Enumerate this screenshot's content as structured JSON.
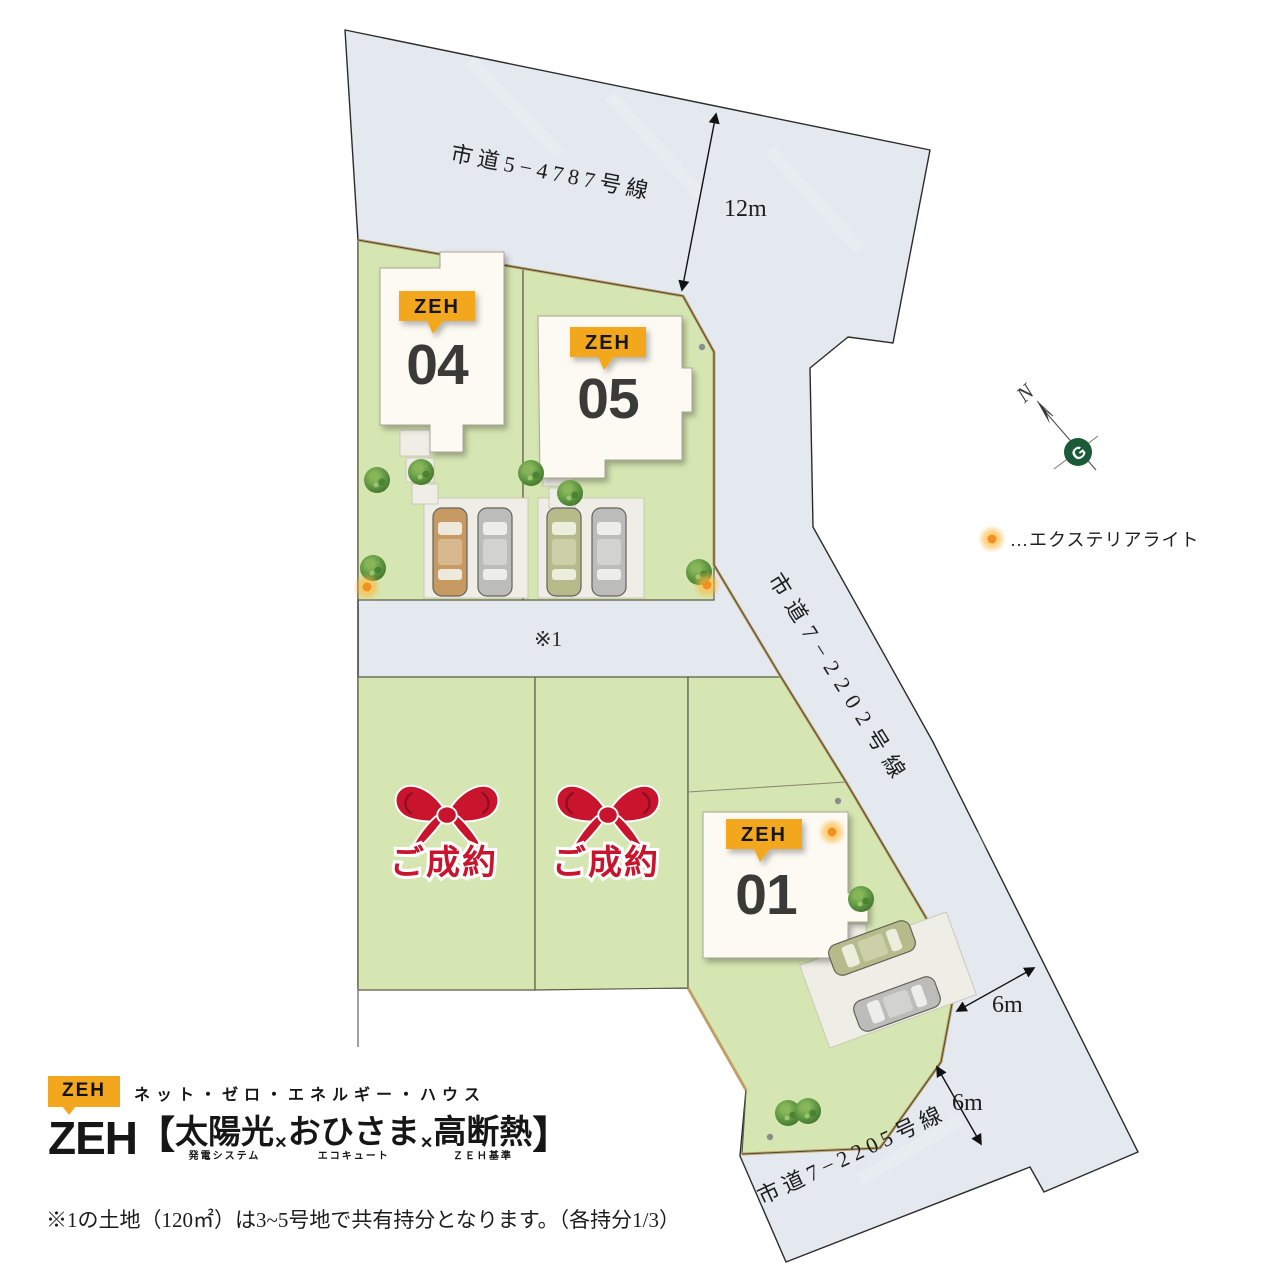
{
  "colors": {
    "accent_yellow": "#F2A71F",
    "sold_red": "#C8142C",
    "lot_green": "#D6E6B2",
    "road_gray": "#E4E9EF",
    "number_dark": "#3A3A38",
    "logo_green": "#1B5A36"
  },
  "map": {
    "roads": {
      "top": "市道5−4787号線",
      "east": "市道7−2202号線",
      "south": "市道7−2205号線"
    },
    "dimensions": {
      "top_road_width": "12m",
      "east_gap": "6m",
      "south_gap": "6m"
    },
    "shared_area_marker": "※1",
    "compass_label": "N",
    "legend": {
      "marker": "exterior-light",
      "label": "…エクステリアライト"
    },
    "lots": [
      {
        "id": "04",
        "badge": "ZEH"
      },
      {
        "id": "05",
        "badge": "ZEH"
      },
      {
        "id": "01",
        "badge": "ZEH"
      },
      {
        "label": "ご成約"
      },
      {
        "label": "ご成約"
      }
    ]
  },
  "branding": {
    "badge": "ZEH",
    "subtitle": "ネット・ゼロ・エネルギー・ハウス",
    "title_zeh": "ZEH",
    "bracket_open": "【",
    "bracket_close": "】",
    "multiplier": "×",
    "features": [
      {
        "main": "太陽光",
        "sub": "発電システム"
      },
      {
        "main": "おひさま",
        "sub": "エコキュート"
      },
      {
        "main": "高断熱",
        "sub": "ＺＥＨ基準"
      }
    ]
  },
  "note": "※1の土地（120㎡）は3~5号地で共有持分となります。（各持分1/3）"
}
